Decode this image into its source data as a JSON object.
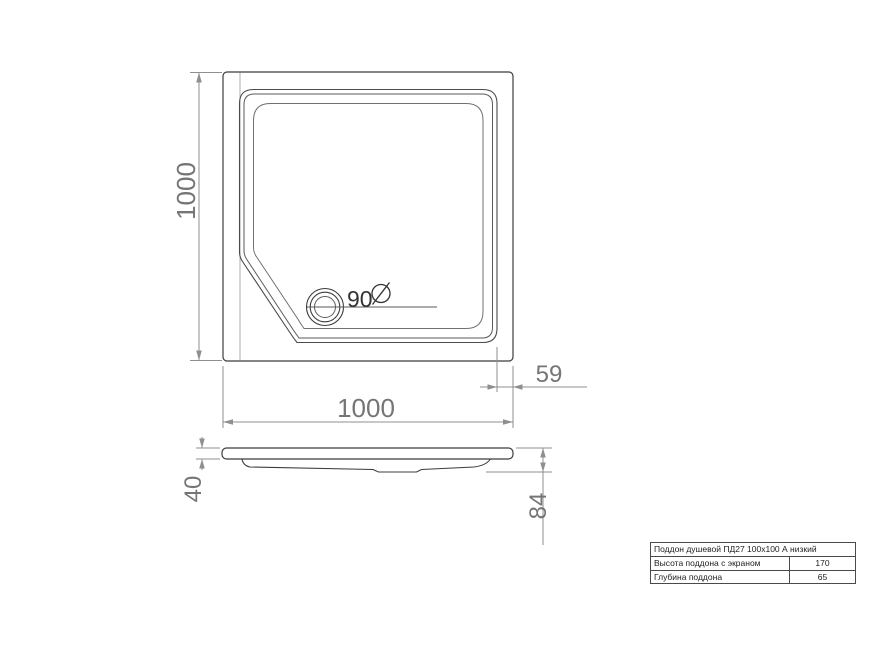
{
  "drawing": {
    "dimensions": {
      "top_height": "1000",
      "top_width": "1000",
      "drain_offset": "59",
      "drain_diameter": "90",
      "rim_height": "40",
      "total_height": "84"
    },
    "spec_table": {
      "title": "Поддон душевой ПД27 100x100 А низкий",
      "rows": [
        {
          "label": "Высота поддона с экраном",
          "value": "170"
        },
        {
          "label": "Глубина поддона",
          "value": "65"
        }
      ]
    },
    "colors": {
      "line_main": "#3c3c3c",
      "line_dim": "#8f8f8f",
      "text_dim": "#757575",
      "background": "#ffffff"
    }
  }
}
